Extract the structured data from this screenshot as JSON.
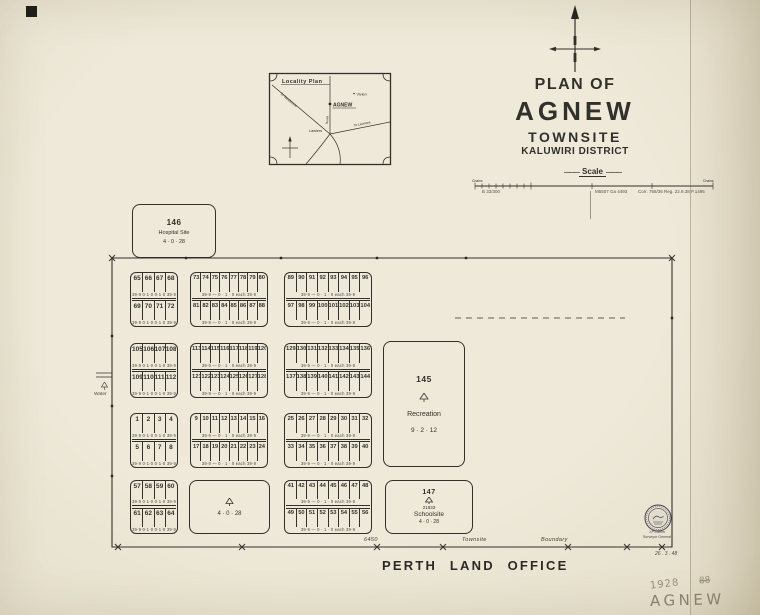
{
  "header": {
    "plan_of": "PLAN OF",
    "name": "AGNEW",
    "townsite": "TOWNSITE",
    "district": "KALUWIRI DISTRICT"
  },
  "scale": {
    "label": "Scale",
    "chains": "Chains",
    "note_left": "B 33/300",
    "note_mid": "M5507 Ga 4493",
    "note_right": "Corr. 768/36   Reg. 22.9.38   P.1495"
  },
  "locality": {
    "title": "Locality Plan",
    "agnew": "AGNEW",
    "lawlers": "Lawlers",
    "vivien": "Vivien",
    "to_leonora": "To Leonora",
    "to_sandstone": "To Sandstone",
    "road": "Road"
  },
  "parcels": {
    "hospital": {
      "lot": "146",
      "name": "Hospital Site",
      "area": "4 · 0 · 28"
    },
    "recreation": {
      "lot": "145",
      "name": "Recreation",
      "area": "9 · 2 · 12"
    },
    "school": {
      "lot": "147",
      "reserve": "21833",
      "name": "Schoolsite",
      "area": "4 · 0 · 28"
    },
    "reserve": {
      "area": "4 · 0 · 28"
    }
  },
  "west": {
    "water": "Water"
  },
  "boundary": {
    "length": "6450",
    "word1": "Townsite",
    "word2": "Boundary",
    "survey_date": "26 . 3 . 48"
  },
  "footer": {
    "office": "PERTH LAND OFFICE"
  },
  "seal": {
    "imprint1": "J.P.Camm",
    "imprint2": "Surveyor General"
  },
  "pencil": {
    "year": "1928",
    "crossed": "88",
    "name": "AGNEW"
  },
  "notes": {
    "n4": "39·9  0·1·0  0·1·0  39·9",
    "n8": "39·9 —  0 · 1 · 0   each   39·9"
  },
  "blocks": [
    {
      "note": "n4",
      "rows": [
        [
          "65",
          "66",
          "67",
          "68"
        ],
        [
          "69",
          "70",
          "71",
          "72"
        ]
      ]
    },
    {
      "note": "n8",
      "rows": [
        [
          "73",
          "74",
          "75",
          "76",
          "77",
          "78",
          "79",
          "80"
        ],
        [
          "81",
          "82",
          "83",
          "84",
          "85",
          "86",
          "87",
          "88"
        ]
      ]
    },
    {
      "note": "n8",
      "rows": [
        [
          "89",
          "90",
          "91",
          "92",
          "93",
          "94",
          "95",
          "96"
        ],
        [
          "97",
          "98",
          "99",
          "100",
          "101",
          "102",
          "103",
          "104"
        ]
      ]
    },
    {
      "note": "n4",
      "rows": [
        [
          "105",
          "106",
          "107",
          "108"
        ],
        [
          "109",
          "110",
          "111",
          "112"
        ]
      ]
    },
    {
      "note": "n8",
      "rows": [
        [
          "113",
          "114",
          "115",
          "116",
          "117",
          "118",
          "119",
          "120"
        ],
        [
          "121",
          "122",
          "123",
          "124",
          "125",
          "126",
          "127",
          "128"
        ]
      ]
    },
    {
      "note": "n8",
      "rows": [
        [
          "129",
          "130",
          "131",
          "132",
          "133",
          "134",
          "135",
          "136"
        ],
        [
          "137",
          "138",
          "139",
          "140",
          "141",
          "142",
          "143",
          "144"
        ]
      ]
    },
    {
      "note": "n4",
      "rows": [
        [
          "1",
          "2",
          "3",
          "4"
        ],
        [
          "5",
          "6",
          "7",
          "8"
        ]
      ]
    },
    {
      "note": "n8",
      "rows": [
        [
          "9",
          "10",
          "11",
          "12",
          "13",
          "14",
          "15",
          "16"
        ],
        [
          "17",
          "18",
          "19",
          "20",
          "21",
          "22",
          "23",
          "24"
        ]
      ]
    },
    {
      "note": "n8",
      "rows": [
        [
          "25",
          "26",
          "27",
          "28",
          "29",
          "30",
          "31",
          "32"
        ],
        [
          "33",
          "34",
          "35",
          "36",
          "37",
          "38",
          "39",
          "40"
        ]
      ]
    },
    {
      "note": "n4",
      "rows": [
        [
          "57",
          "58",
          "59",
          "60"
        ],
        [
          "61",
          "62",
          "63",
          "64"
        ]
      ]
    },
    {
      "note": "n8",
      "rows": [
        [
          "41",
          "42",
          "43",
          "44",
          "45",
          "46",
          "47",
          "48"
        ],
        [
          "49",
          "50",
          "51",
          "52",
          "53",
          "54",
          "55",
          "56"
        ]
      ]
    }
  ]
}
